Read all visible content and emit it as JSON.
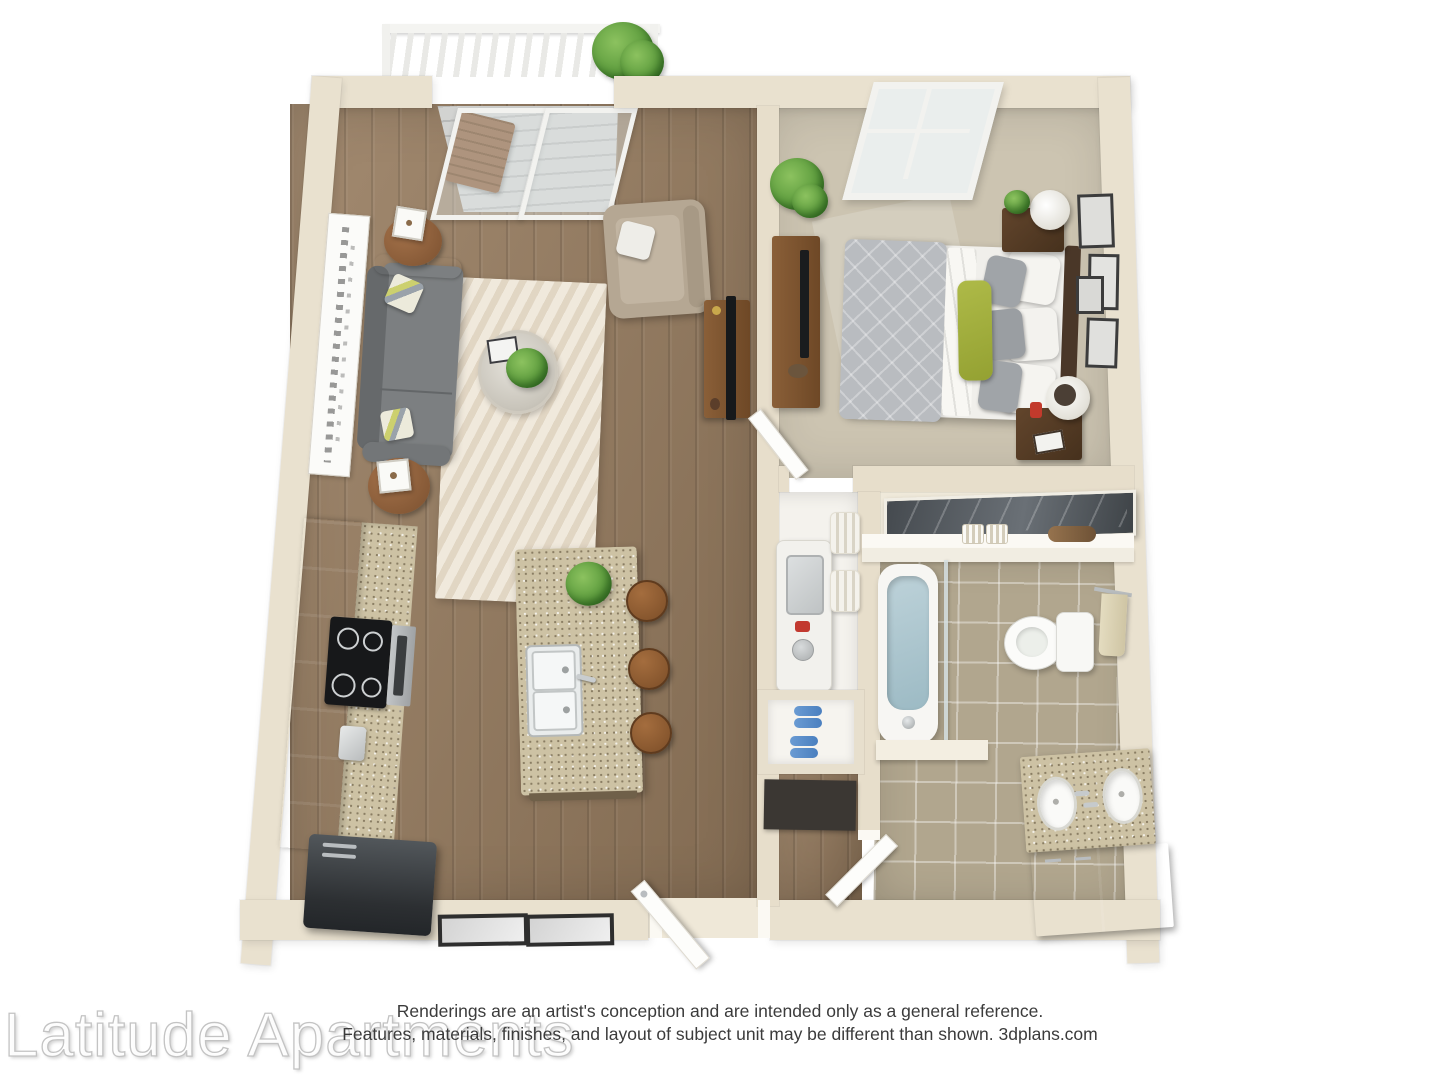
{
  "watermark": {
    "text": "Latitude Apartments"
  },
  "disclaimer": {
    "line1": "Renderings are an artist's conception and are intended only as a general reference.",
    "line2": "Features, materials, finishes, and layout of subject unit may be different than shown. 3dplans.com"
  },
  "plan": {
    "kind": "3d-floor-plan-top-view",
    "unit_type": "one-bedroom one-bath apartment with balcony",
    "rooms": [
      {
        "name": "balcony",
        "features": [
          "white-railing",
          "potted-plant",
          "wood-deck-chair",
          "sliding-glass-door"
        ]
      },
      {
        "name": "living-room",
        "floor": "hardwood",
        "features": [
          "gray-sofa",
          "accent-pillows",
          "wall-art",
          "round-end-tables",
          "cube-lamps",
          "chevron-area-rug",
          "round-glass-coffee-table",
          "house-plant",
          "tan-armchair",
          "tv-console",
          "flat-tv"
        ]
      },
      {
        "name": "bedroom",
        "floor": "carpet",
        "features": [
          "bed-gray-duvet",
          "green-accent-pillow",
          "dark-headboard",
          "nightstand-north",
          "nightstand-south",
          "cylinder-lamps",
          "dresser-with-tv",
          "corner-plant",
          "window",
          "four-wall-frames",
          "swing-door"
        ]
      },
      {
        "name": "kitchen",
        "floor": "hardwood",
        "features": [
          "espresso-cabinet-run",
          "granite-counter",
          "black-cooktop",
          "stainless-oven",
          "coffee-maker",
          "dark-refrigerator",
          "granite-island",
          "double-sink",
          "three-bar-stools",
          "island-plant",
          "framed-mats"
        ]
      },
      {
        "name": "laundry-closet",
        "features": [
          "stacked-washer",
          "rolled-towel-shelf",
          "shoe-cubby",
          "floor-mat"
        ]
      },
      {
        "name": "closet",
        "features": [
          "sliding-mirror-door",
          "white-shelf",
          "knit-bins",
          "clutch-bag"
        ]
      },
      {
        "name": "bathroom",
        "floor": "tile",
        "features": [
          "soaking-tub",
          "glass-panel",
          "toilet",
          "towel-bar",
          "double-sink-granite-vanity",
          "swing-door",
          "half-wall"
        ]
      },
      {
        "name": "entry",
        "features": [
          "front-door-open"
        ]
      }
    ],
    "colors": {
      "background": "#ffffff",
      "wall": "#e9e1cf",
      "interior_wall": "#e7decb",
      "hardwood": "#977c5f",
      "carpet": "#ccc4b1",
      "tile": "#b1a68e",
      "granite": "#cdc2a4",
      "espresso_cabinet": "#3a2d23",
      "sofa_gray": "#7b7e80",
      "armchair_tan": "#b5a793",
      "rug_cream": "#f0e9dc",
      "duvet_gray": "#b9bcc0",
      "pillow_green": "#a2af3e",
      "wood_furniture": "#8a5c36",
      "appliance_dark": "#33373b",
      "tub_water": "#a9c4cd",
      "plant_green": "#5f9e3f",
      "shoes_blue": "#5b8fc9",
      "towel_tan": "#d9d0b0"
    }
  }
}
